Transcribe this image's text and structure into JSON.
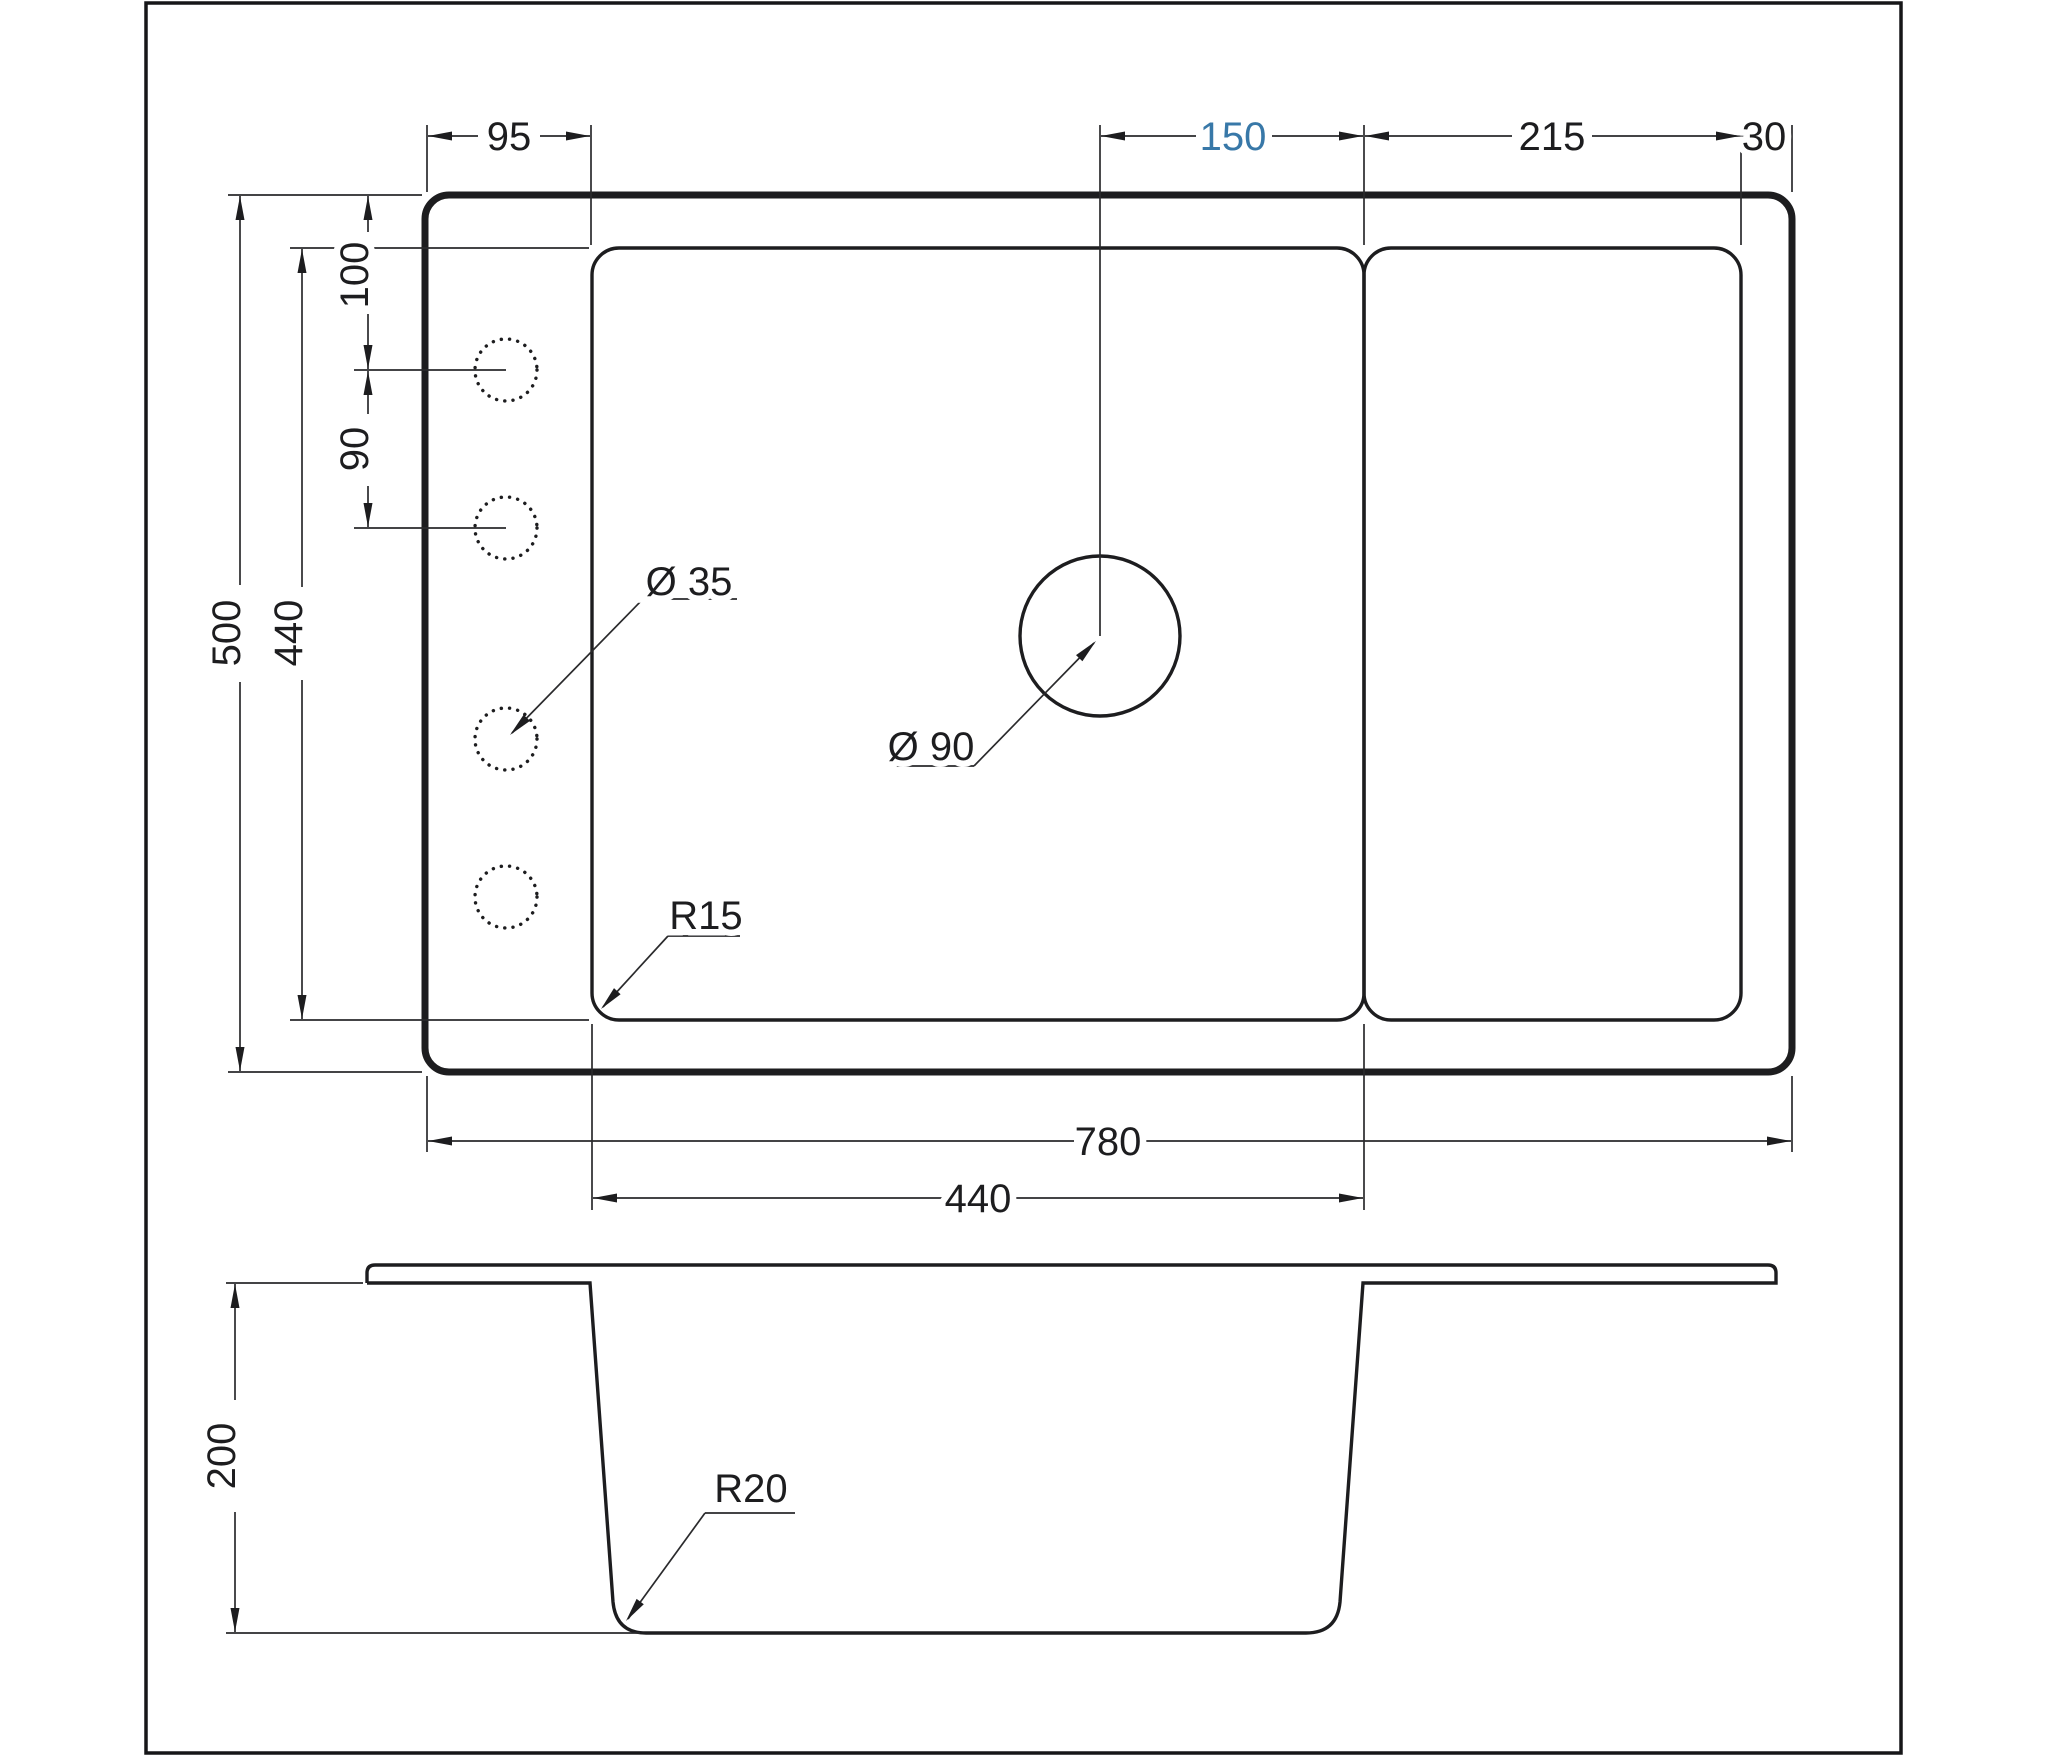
{
  "drawing": {
    "kind": "sink technical drawing, top view and section view",
    "colors": {
      "line": "#1d1d1f",
      "accent_blue": "#3878a8",
      "background": "#ffffff"
    }
  },
  "top_view": {
    "dims": {
      "rim_to_bowl_left": "95",
      "faucet_to_bowl_right": "150",
      "drainboard_width": "215",
      "right_margin": "30",
      "top_to_hole1": "100",
      "hole_spacing": "90",
      "overall_depth": "500",
      "bowl_depth": "440",
      "overall_width": "780",
      "bowl_width": "440"
    },
    "labels": {
      "hole_diameter": "Ø 35",
      "faucet_diameter": "Ø 90",
      "corner_radius": "R15"
    }
  },
  "section_view": {
    "dims": {
      "bowl_height": "200"
    },
    "labels": {
      "bottom_radius": "R20"
    }
  }
}
